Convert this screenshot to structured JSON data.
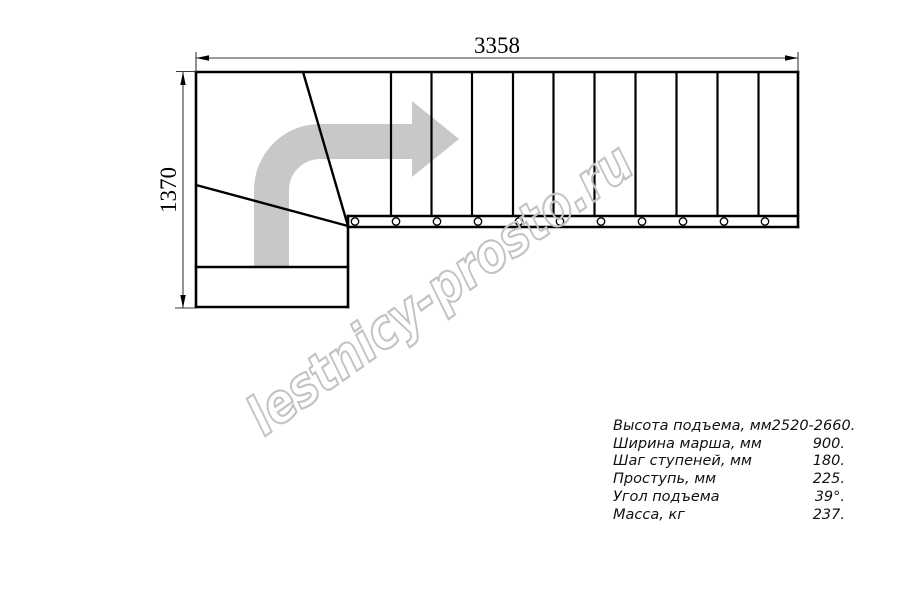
{
  "watermark": {
    "text": "lestnicy-prosto.ru"
  },
  "dimensions": {
    "width_label": "3358",
    "height_label": "1370"
  },
  "plan": {
    "straight_tread_count": 11,
    "winder_tread_count": 3,
    "entry_tread_count": 1
  },
  "specs": {
    "rows": [
      {
        "label": "Высота подъема, мм",
        "value": "2520-2660."
      },
      {
        "label": "Ширина марша, мм",
        "value": "900."
      },
      {
        "label": "Шаг ступеней, мм",
        "value": "180."
      },
      {
        "label": "Проступь, мм",
        "value": "225."
      },
      {
        "label": "Угол подъема",
        "value": "39°."
      },
      {
        "label": "Масса, кг",
        "value": "237."
      }
    ]
  },
  "colors": {
    "line": "#000000",
    "dimension": "#3a3a3a",
    "arrow_fill": "#c8c8c8",
    "watermark_stroke": "#c3c3c3"
  }
}
